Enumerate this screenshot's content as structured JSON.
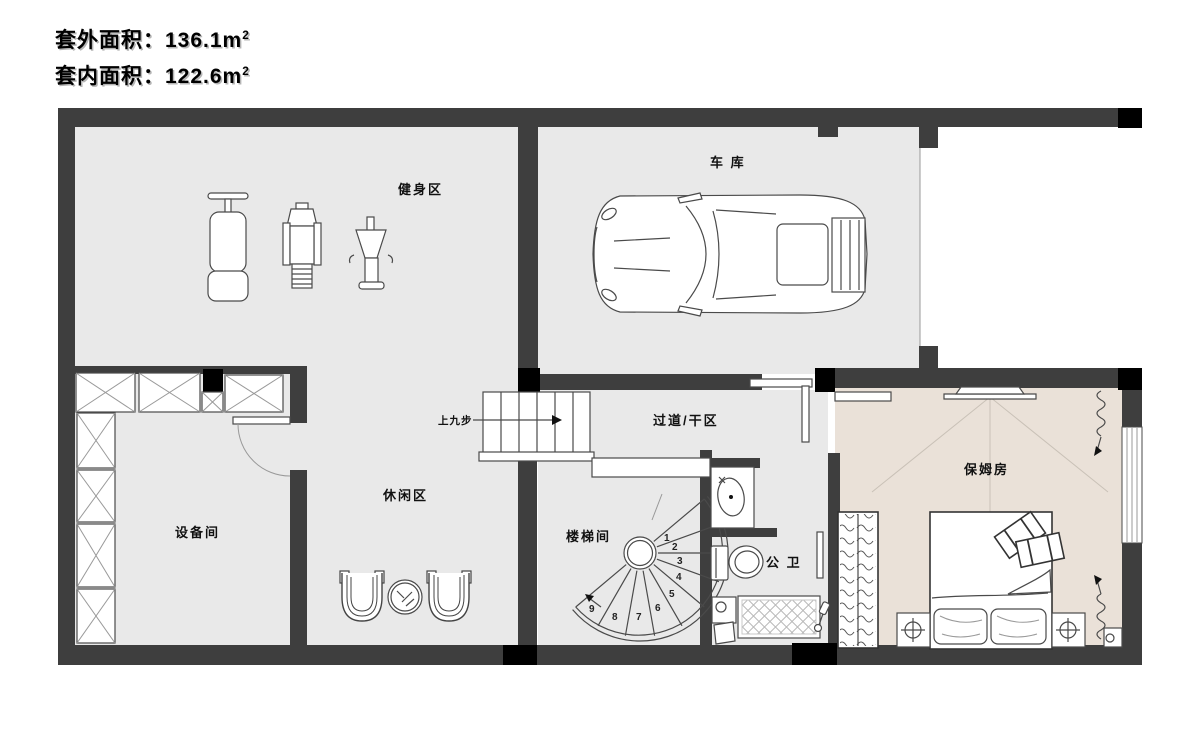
{
  "title": {
    "lines": [
      {
        "label": "套外面积：",
        "value": "136.1m",
        "sup": "2"
      },
      {
        "label": "套内面积：",
        "value": "122.6m",
        "sup": "2"
      }
    ]
  },
  "rooms": {
    "gym": "健身区",
    "garage": "车 库",
    "corridor": "过道/干区",
    "leisure": "休闲区",
    "equipment": "设备间",
    "stairwell": "楼梯间",
    "bathroom": "公 卫",
    "nanny": "保姆房",
    "stair_note": "上九步"
  },
  "stairs": {
    "numbers": [
      "1",
      "2",
      "3",
      "4",
      "5",
      "6",
      "7",
      "8",
      "9"
    ]
  },
  "colors": {
    "wall": "#3e3e3e",
    "column": "#000000",
    "floor_gray": "#e9e9e9",
    "floor_beige": "#eae1d8",
    "outline": "#4a4a4a",
    "background": "#ffffff"
  }
}
